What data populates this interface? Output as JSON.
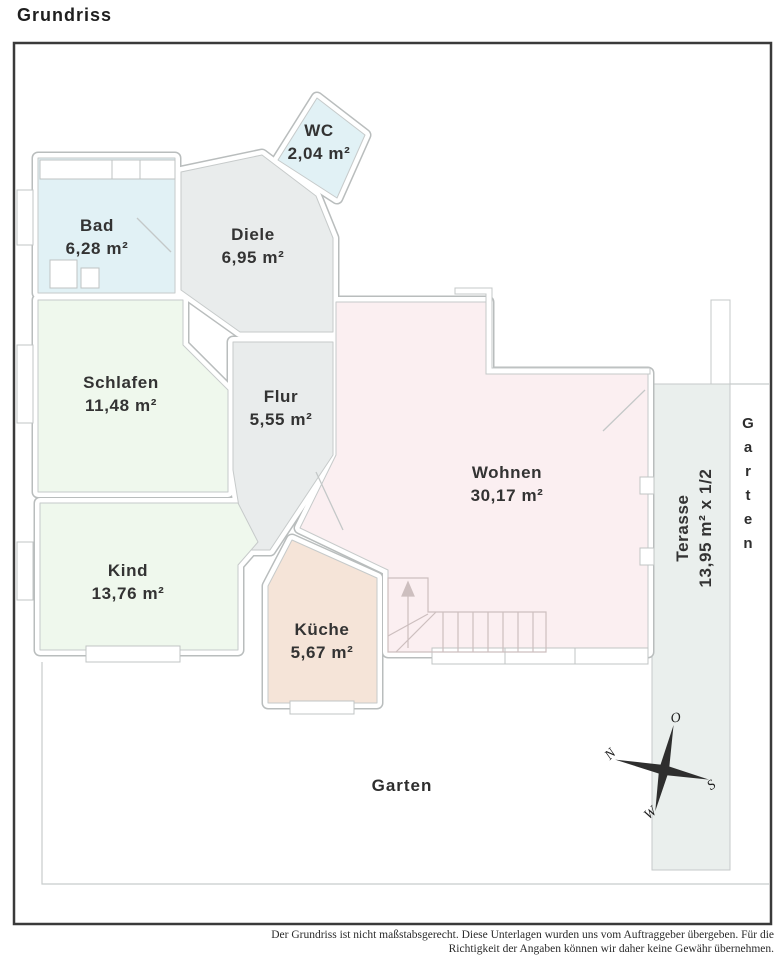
{
  "page": {
    "title": "Grundriss"
  },
  "rooms": [
    {
      "id": "bad",
      "label": "Bad",
      "area": "6,28 m²",
      "color": "#e1f1f5"
    },
    {
      "id": "wc",
      "label": "WC",
      "area": "2,04 m²",
      "color": "#e1f1f5"
    },
    {
      "id": "diele",
      "label": "Diele",
      "area": "6,95 m²",
      "color": "#e9ecec"
    },
    {
      "id": "schlafen",
      "label": "Schlafen",
      "area": "11,48 m²",
      "color": "#eff8ed"
    },
    {
      "id": "flur",
      "label": "Flur",
      "area": "5,55 m²",
      "color": "#e9ecec"
    },
    {
      "id": "wohnen",
      "label": "Wohnen",
      "area": "30,17 m²",
      "color": "#fbeff1"
    },
    {
      "id": "kind",
      "label": "Kind",
      "area": "13,76 m²",
      "color": "#eff8ed"
    },
    {
      "id": "kueche",
      "label": "Küche",
      "area": "5,67 m²",
      "color": "#f5e4d8"
    },
    {
      "id": "terasse",
      "label": "Terasse",
      "area": "13,95 m² x 1/2",
      "color": "#eaefed"
    }
  ],
  "labels": {
    "garten_side": "Garten",
    "garten_bottom": "Garten"
  },
  "compass": {
    "north": "N",
    "east": "O",
    "south": "S",
    "west": "W"
  },
  "footer": {
    "line1": "Der Grundriss ist nicht maßstabsgerecht. Diese Unterlagen wurden uns vom Auftraggeber übergeben. Für die",
    "line2": "Richtigkeit der Angaben können wir daher keine Gewähr übernehmen."
  },
  "colors": {
    "wall_edge": "#b9bdbd",
    "thin_line": "#c8cccc",
    "frame": "#3a3a3a",
    "stair_line": "#cdbfbf",
    "text": "#333333"
  }
}
